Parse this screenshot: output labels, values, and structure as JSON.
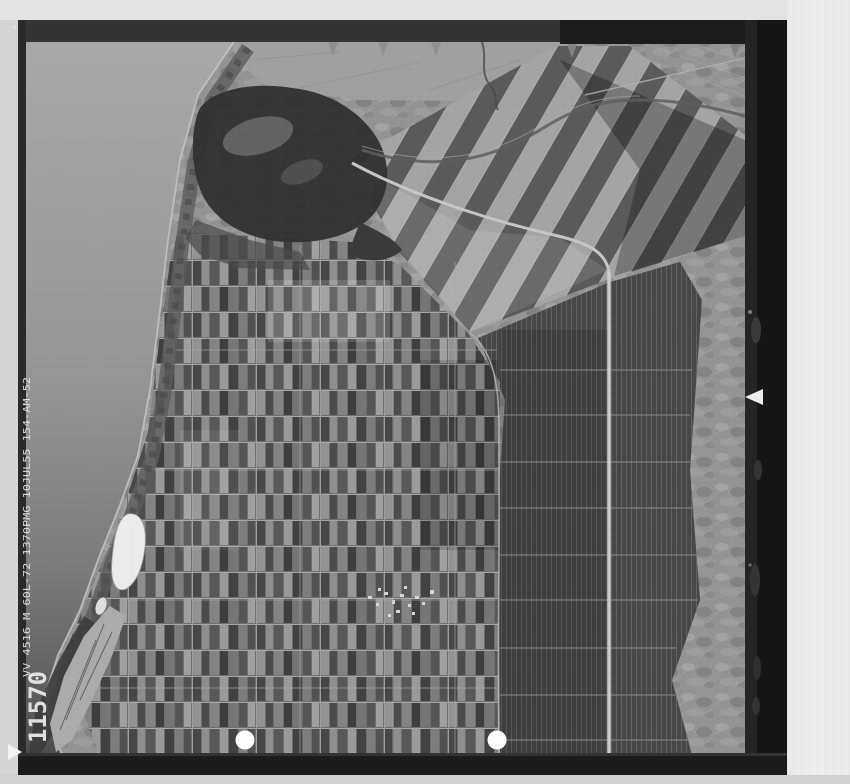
{
  "photo": {
    "frame_number": "11570",
    "edge_text": "VV 4516 M 60L-72   1370PMG   10JUL55   154-AM-52",
    "scene": "black-and-white vertical aerial photograph of a coastal plain: sea and dune belt on the left, dark lagoon at upper left, dense patchwork of small farm fields in the center, long strip fields to the east, light hilly terrain at far right",
    "punch_hole_count": 2
  },
  "colors": {
    "page_background": "#dcdcdc",
    "margin_top": "#e3e3e3",
    "margin_right": "#ececec",
    "margin_left": "#d5d5d5",
    "margin_bottom": "#d0d0d0",
    "film_frame": "#1a1a1a",
    "sea_top": "#a6a6a6",
    "sea_bottom": "#4f4f4f",
    "lagoon": "#323232",
    "fields_light": "#a4a4a4",
    "fields_dark": "#474747",
    "road": "#cdcdcd",
    "lake": "#ebebeb",
    "punch_hole": "#fdfdfd",
    "annotation_text": "#e8e8e8"
  }
}
